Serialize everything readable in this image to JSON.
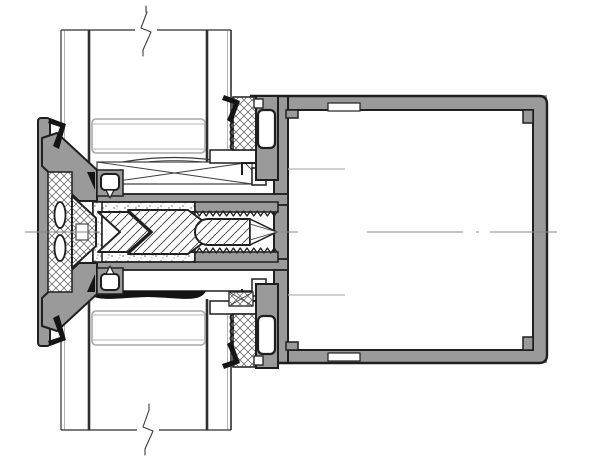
{
  "meta": {
    "title": "Aluminium mullion cross-section detail drawing",
    "drawing_type": "CAD section detail"
  },
  "colors": {
    "background": "#ffffff",
    "paper": "#ffffff",
    "outline": "#1f1f1f",
    "aluminum": "#9a9a9a",
    "gasket": "#141414",
    "thin": "#3c3c3c",
    "light": "#b5b5b5",
    "centerline": "#8a8a8a",
    "glass": "#2e2e2e",
    "spacer": "#a9a9a9",
    "hatch_line": "#3c3c3c",
    "crosshatch_line": "#565656",
    "stipple_dot": "#5a5a5a"
  },
  "components": {
    "glazing_top": {
      "label": "insulated glazing unit (upper), cut by break line"
    },
    "glazing_bottom": {
      "label": "insulated glazing unit (lower), cut by break line"
    },
    "spacer_top": {
      "label": "glazing spacer bar"
    },
    "spacer_bottom": {
      "label": "glazing spacer bar"
    },
    "cover_cap": {
      "label": "pressure plate / cover cap profile with thermal isolator"
    },
    "isolator": {
      "label": "crosshatched thermal isolator with oval slots"
    },
    "screw": {
      "label": "self-tapping fastening screw"
    },
    "screw_boss": {
      "label": "serrated screw channel of mullion"
    },
    "setting_block": {
      "label": "glazing support block (crossed rectangle)"
    },
    "gasket_lens": {
      "label": "compressed glazing gasket"
    },
    "bead_top": {
      "label": "glazing gasket and bead profile (upper)"
    },
    "bead_bottom": {
      "label": "glazing gasket and bead profile (lower)"
    },
    "tube": {
      "label": "square hollow mullion tube profile"
    },
    "centerline": {
      "label": "horizontal section centerline (dash-dot)"
    },
    "break_top": {
      "label": "break line symbol (top)"
    },
    "break_bottom": {
      "label": "break line symbol (bottom)"
    }
  }
}
